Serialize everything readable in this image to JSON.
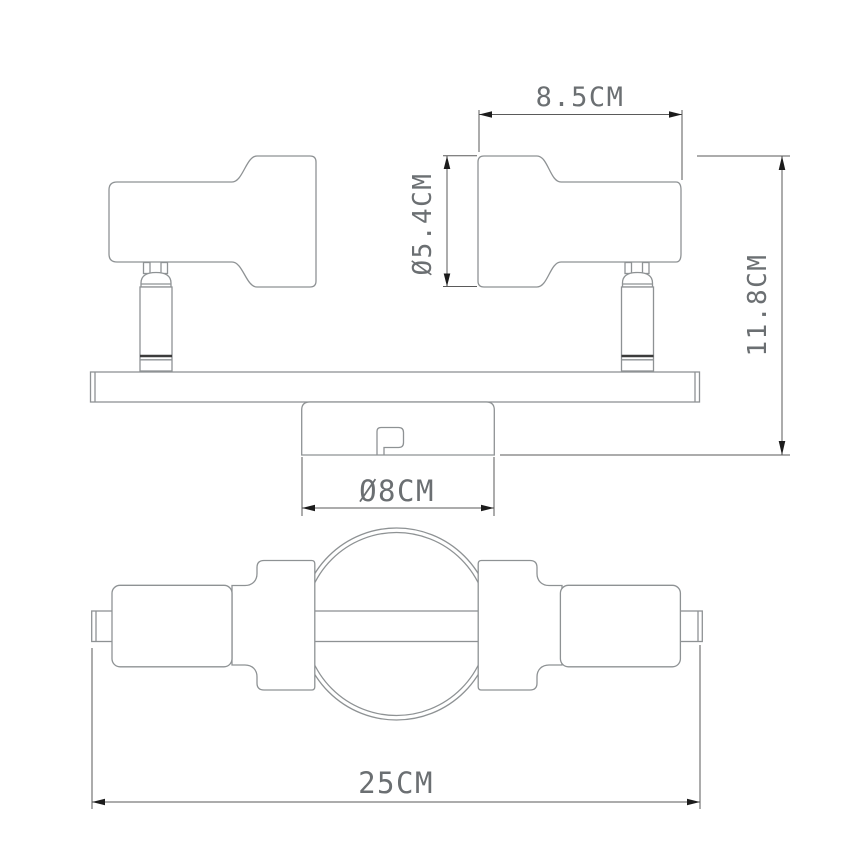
{
  "drawing": {
    "type": "technical-dimension-drawing",
    "subject": "two-head ceiling spotlight fixture",
    "views": {
      "top_view": "side profile with two swivel spot heads on mounting bar and ceiling canopy",
      "bottom_view": "underside view with round canopy and two cylindrical heads"
    },
    "dims": {
      "head_width": {
        "label": "8.5CM"
      },
      "head_diameter": {
        "label": "Ø5.4CM"
      },
      "fixture_height": {
        "label": "11.8CM"
      },
      "canopy_diameter": {
        "label": "Ø8CM"
      },
      "fixture_width": {
        "label": "25CM"
      }
    },
    "colors": {
      "background": "#ffffff",
      "geometry_line": "#8e9294",
      "dimension_line": "#5a5a5a",
      "dimension_text": "#6b6f72",
      "arrowhead": "#1c1c1c"
    }
  }
}
